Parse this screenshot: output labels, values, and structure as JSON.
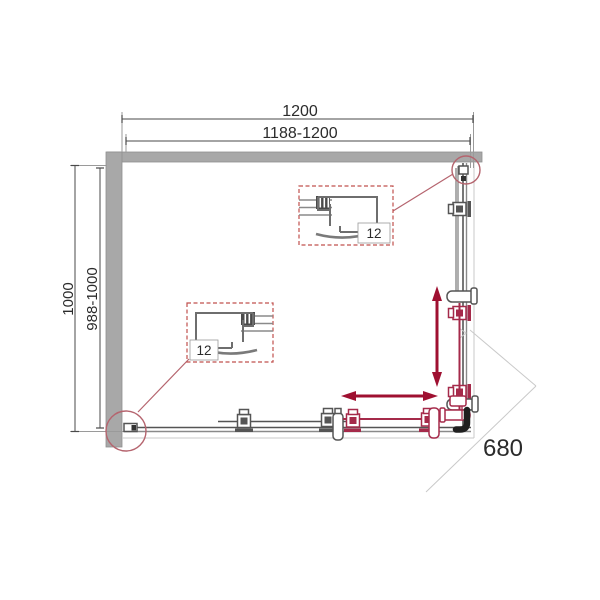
{
  "dimensions": {
    "width_total": "1200",
    "width_range": "1188-1200",
    "height_total": "1000",
    "height_range": "988-1000",
    "entry_diagonal": "680"
  },
  "details": {
    "top_box_label": "12",
    "bottom_box_label": "12"
  },
  "icons": {
    "slide_vertical": "double-arrow-vertical",
    "slide_horizontal": "double-arrow-horizontal",
    "detail_callout": "circle-magnifier"
  },
  "colors": {
    "wall": "#a8a8a8",
    "frame": "#555555",
    "door_red": "#a52a4a",
    "arrow_red": "#9f1031",
    "callout": "#b5646e",
    "detail_box": "#c0504d",
    "text": "#2b2b2b"
  }
}
